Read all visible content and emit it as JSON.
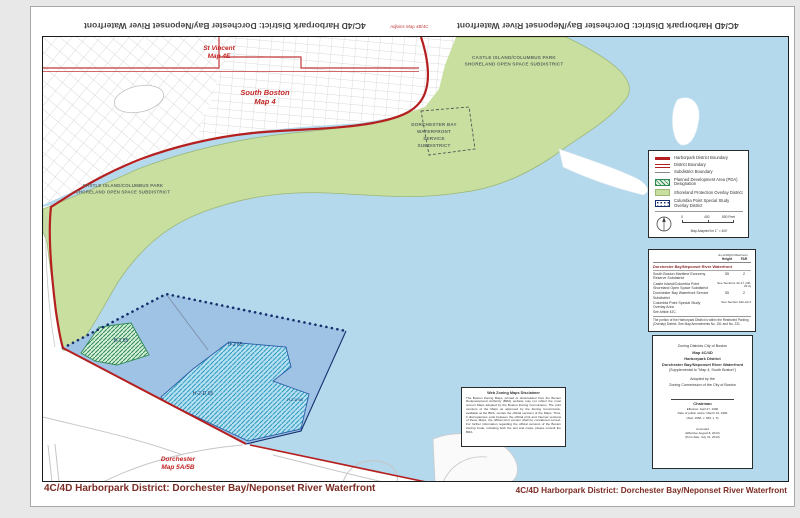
{
  "page": {
    "top_title_left": "4C/4D Harborpark District: Dorchester Bay/Neponset River Waterfront",
    "top_title_right": "4C/4D Harborpark District: Dorchester Bay/Neponset River Waterfront",
    "adjoins_note": "Adjoins Map 4B/4C",
    "footer_left": "4C/4D Harborpark District: Dorchester Bay/Neponset River Waterfront",
    "footer_right": "4C/4D Harborpark District: Dorchester Bay/Neponset River Waterfront"
  },
  "map": {
    "labels": {
      "st_vincent_1": "St Vincent",
      "st_vincent_2": "Map 4E",
      "south_boston_1": "South Boston",
      "south_boston_2": "Map 4",
      "castle_1": "CASTLE ISLAND/COLUMBUS PARK",
      "castle_2": "SHORELAND OPEN SPACE SUBDISTRICT",
      "dbay_1": "DORCHESTER BAY",
      "dbay_2": "WATERFRONT",
      "dbay_3": "SERVICE",
      "dbay_4": "SUBDISTRICT",
      "zone_b1": "B-1 55",
      "zone_h2": "H-2 65",
      "zone_h2d": "H-2-D 65",
      "zone_h2d_small": "H-2-D 65",
      "dorchester_1": "Dorchester",
      "dorchester_2": "Map 5A/5B"
    },
    "colors": {
      "water": "#b4d8ec",
      "shoreland_green": "#c8dfa0",
      "district_red": "#b51f1f",
      "study_area_blue": "#9fc3e4",
      "boundary_navy": "#16306e"
    }
  },
  "legend": {
    "items": [
      {
        "icon": "thick-red-line",
        "label": "Harborpark District Boundary"
      },
      {
        "icon": "double-red-line",
        "label": "District Boundary"
      },
      {
        "icon": "gray-line",
        "label": "Subdistrict Boundary"
      },
      {
        "icon": "green-hatch-swatch",
        "label": "Planned Development Area (PDA) Designation"
      },
      {
        "icon": "green-swatch",
        "label": "Shoreland Protection Overlay District"
      },
      {
        "icon": "blue-dots-swatch",
        "label": "Columbia Point Special Study Overlay District"
      }
    ],
    "scale": {
      "tick0": "0",
      "tick400": "400",
      "tick800": "800 Feet",
      "caption": "Map Adapted for 1\" = 400'"
    }
  },
  "table": {
    "header_group": "As-of-Right Maximum",
    "col_height": "Height",
    "col_far": "FAR",
    "title": "Dorchester Bay/Neponset River Waterfront",
    "rows": [
      {
        "name": "South Boston Maritime Economy Reserve Subdistrict",
        "height": "55",
        "far": "2"
      },
      {
        "name": "Castle Island/Columbia Point Shoreland Open Space Subdistrict",
        "span": "See Sections 42-17 (4D-22.2)"
      },
      {
        "name": "Dorchester Bay Waterfront Service Subdistrict",
        "height": "55",
        "far": "2"
      },
      {
        "name": "Columbia Point Special Study Overlay Area",
        "span": "See Section 42b-22.3"
      }
    ],
    "see_article": "See Article 42C.",
    "note": "The portion of the Harborpark District is within the Restricted Parking (Overlay) District. See Map Amendments No. 151 and No. 231."
  },
  "title_block": {
    "lines": [
      "Zoning Districts City of Boston",
      "Map 4C/4D",
      "Harborpark District",
      "Dorchester Bay/Neponset River Waterfront",
      "(Supplemental to \"Map 4, South Boston\")",
      "Adopted by the",
      "Zoning Commission of the City of Boston",
      "Chairman",
      "Effective: April 27, 1990",
      "Date of public notice: March 16, 1990",
      "(Stat. 1956, c. 665, s. 5)",
      "Amended",
      "(Effective August 8, 2013)",
      "(Print date: July 31, 2013)"
    ]
  },
  "disclaimer": {
    "title": "Web Zoning Maps Disclaimer",
    "body": "The Boston Zoning Maps, printed or downloaded from the Boston Redevelopment Authority (BRA) website may not reflect the most current Maps adopted by the Boston Zoning Commission. The print versions of the Maps as approved by the Zoning Commission, available at the BRA, remain the official versions of the Maps. Thus, if discrepancies exist between the official print and Internet versions of these Maps, the official print version shall be considered correct. For further information regarding the official versions of the Boston Zoning Code, including both the text and maps, please consult the BRA."
  }
}
